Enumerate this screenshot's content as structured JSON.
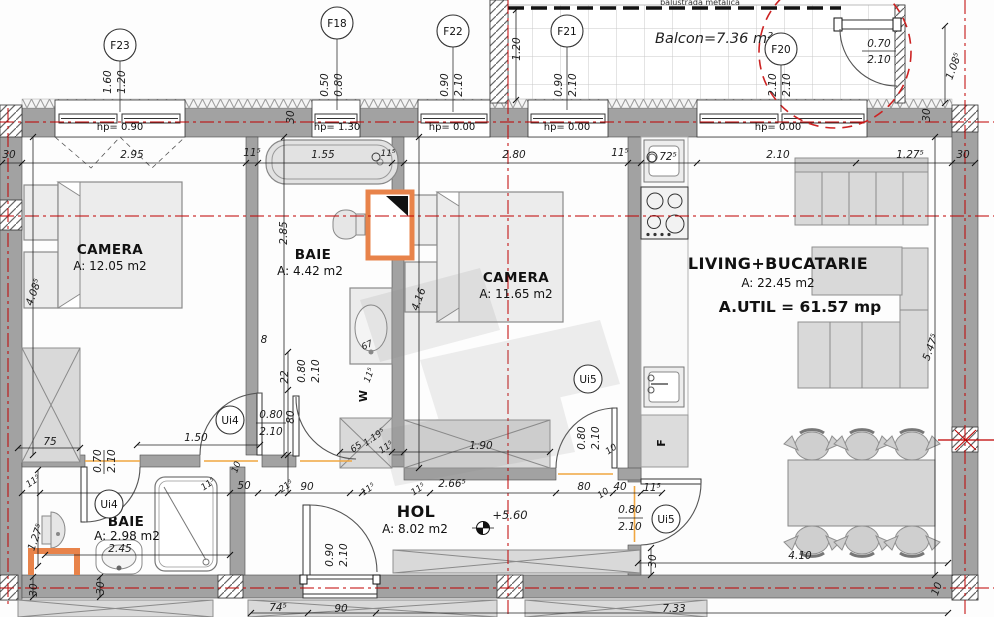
{
  "title": "Apartment floor plan",
  "rooms": {
    "camera1": {
      "name": "CAMERA",
      "area": "A: 12.05 m2"
    },
    "baie1": {
      "name": "BAIE",
      "area": "A: 4.42 m2"
    },
    "camera2": {
      "name": "CAMERA",
      "area": "A: 11.65 m2"
    },
    "living": {
      "name": "LIVING+BUCATARIE",
      "area": "A: 22.45 m2",
      "util": "A.UTIL = 61.57 mp"
    },
    "baie2": {
      "name": "BAIE",
      "area": "A: 2.98 m2"
    },
    "hol": {
      "name": "HOL",
      "area": "A: 8.02 m2"
    },
    "balcon": {
      "label": "Balcon=7.36 m²"
    }
  },
  "windows": [
    {
      "tag": "F23",
      "hp": "hp= 0.90",
      "w": "1.60",
      "h": "1.20"
    },
    {
      "tag": "F18",
      "hp": "hp= 1.30",
      "w": "0.50",
      "h": "0.80"
    },
    {
      "tag": "F22",
      "hp": "hp= 0.00",
      "w": "0.90",
      "h": "2.10"
    },
    {
      "tag": "F21",
      "hp": "hp= 0.00",
      "w": "0.90",
      "h": "2.10"
    },
    {
      "tag": "F20",
      "hp": "hp= 0.00",
      "w": "2.10",
      "h": "2.10"
    }
  ],
  "doors": {
    "ui4_camera": {
      "tag": "Ui4",
      "w": "0.80",
      "h": "2.10"
    },
    "ui4_bath": {
      "tag": "Ui4",
      "w": "0.70",
      "h": "2.10"
    },
    "ui5_camera": {
      "tag": "Ui5",
      "w": "0.80",
      "h": "2.10"
    },
    "ui5_living": {
      "tag": "Ui5",
      "w": "0.80",
      "h": "2.10"
    },
    "balcony_door": {
      "w": "0.70",
      "h": "2.10"
    },
    "entry_door": {
      "w": "0.90",
      "h": "2.10"
    }
  },
  "labels": {
    "balustrade": "balustrada metalica",
    "level": "+5.60",
    "washer": "W",
    "fridge": "F"
  },
  "colors": {
    "axis_red": "#c00000",
    "util_red": "#b02030",
    "appliance_blue": "#5656e0",
    "orange": "#e8834a"
  },
  "dims": {
    "balc_depth": "1.20",
    "balc_h": "1.08⁵",
    "w30_a": "30",
    "w30_b": "30",
    "c30_l": "30",
    "c295": "2.95",
    "c115a": "11⁵",
    "c155": "1.55",
    "c115b": "11⁵",
    "c280": "2.80",
    "c115c": "11⁵",
    "c725": "72⁵",
    "c210": "2.10",
    "c1275": "1.27⁵",
    "c30_r": "30",
    "v4085": "4.08⁵",
    "v285": "2.85",
    "v416": "4.16",
    "v5475": "5.47⁵",
    "d75": "75",
    "d150": "1.50",
    "d8": "8",
    "d22": "22",
    "d080r": "0.80",
    "d210r": "2.10",
    "d80r": "80",
    "d65": "65",
    "d1195": "1.19⁵",
    "d115w": "11⁵",
    "d67": "67",
    "d115s": "11⁵",
    "d190": "1.90",
    "d10a": "10",
    "r115a": "11⁵",
    "v1275": "1.27⁵",
    "d245": "2.45",
    "r115b": "11⁵",
    "r50": "50",
    "r215": "21⁵",
    "r90": "90",
    "r115c": "11⁵",
    "r115d": "11⁵",
    "r2665": "2.66⁵",
    "r80": "80",
    "r10": "10",
    "r40": "40",
    "r115e": "11⁵",
    "d10b": "10",
    "h30": "30",
    "d410": "4.10",
    "b10": "10",
    "b30a": "30",
    "b30b": "30",
    "b745": "74⁵",
    "b90": "90",
    "b733": "7.33"
  }
}
